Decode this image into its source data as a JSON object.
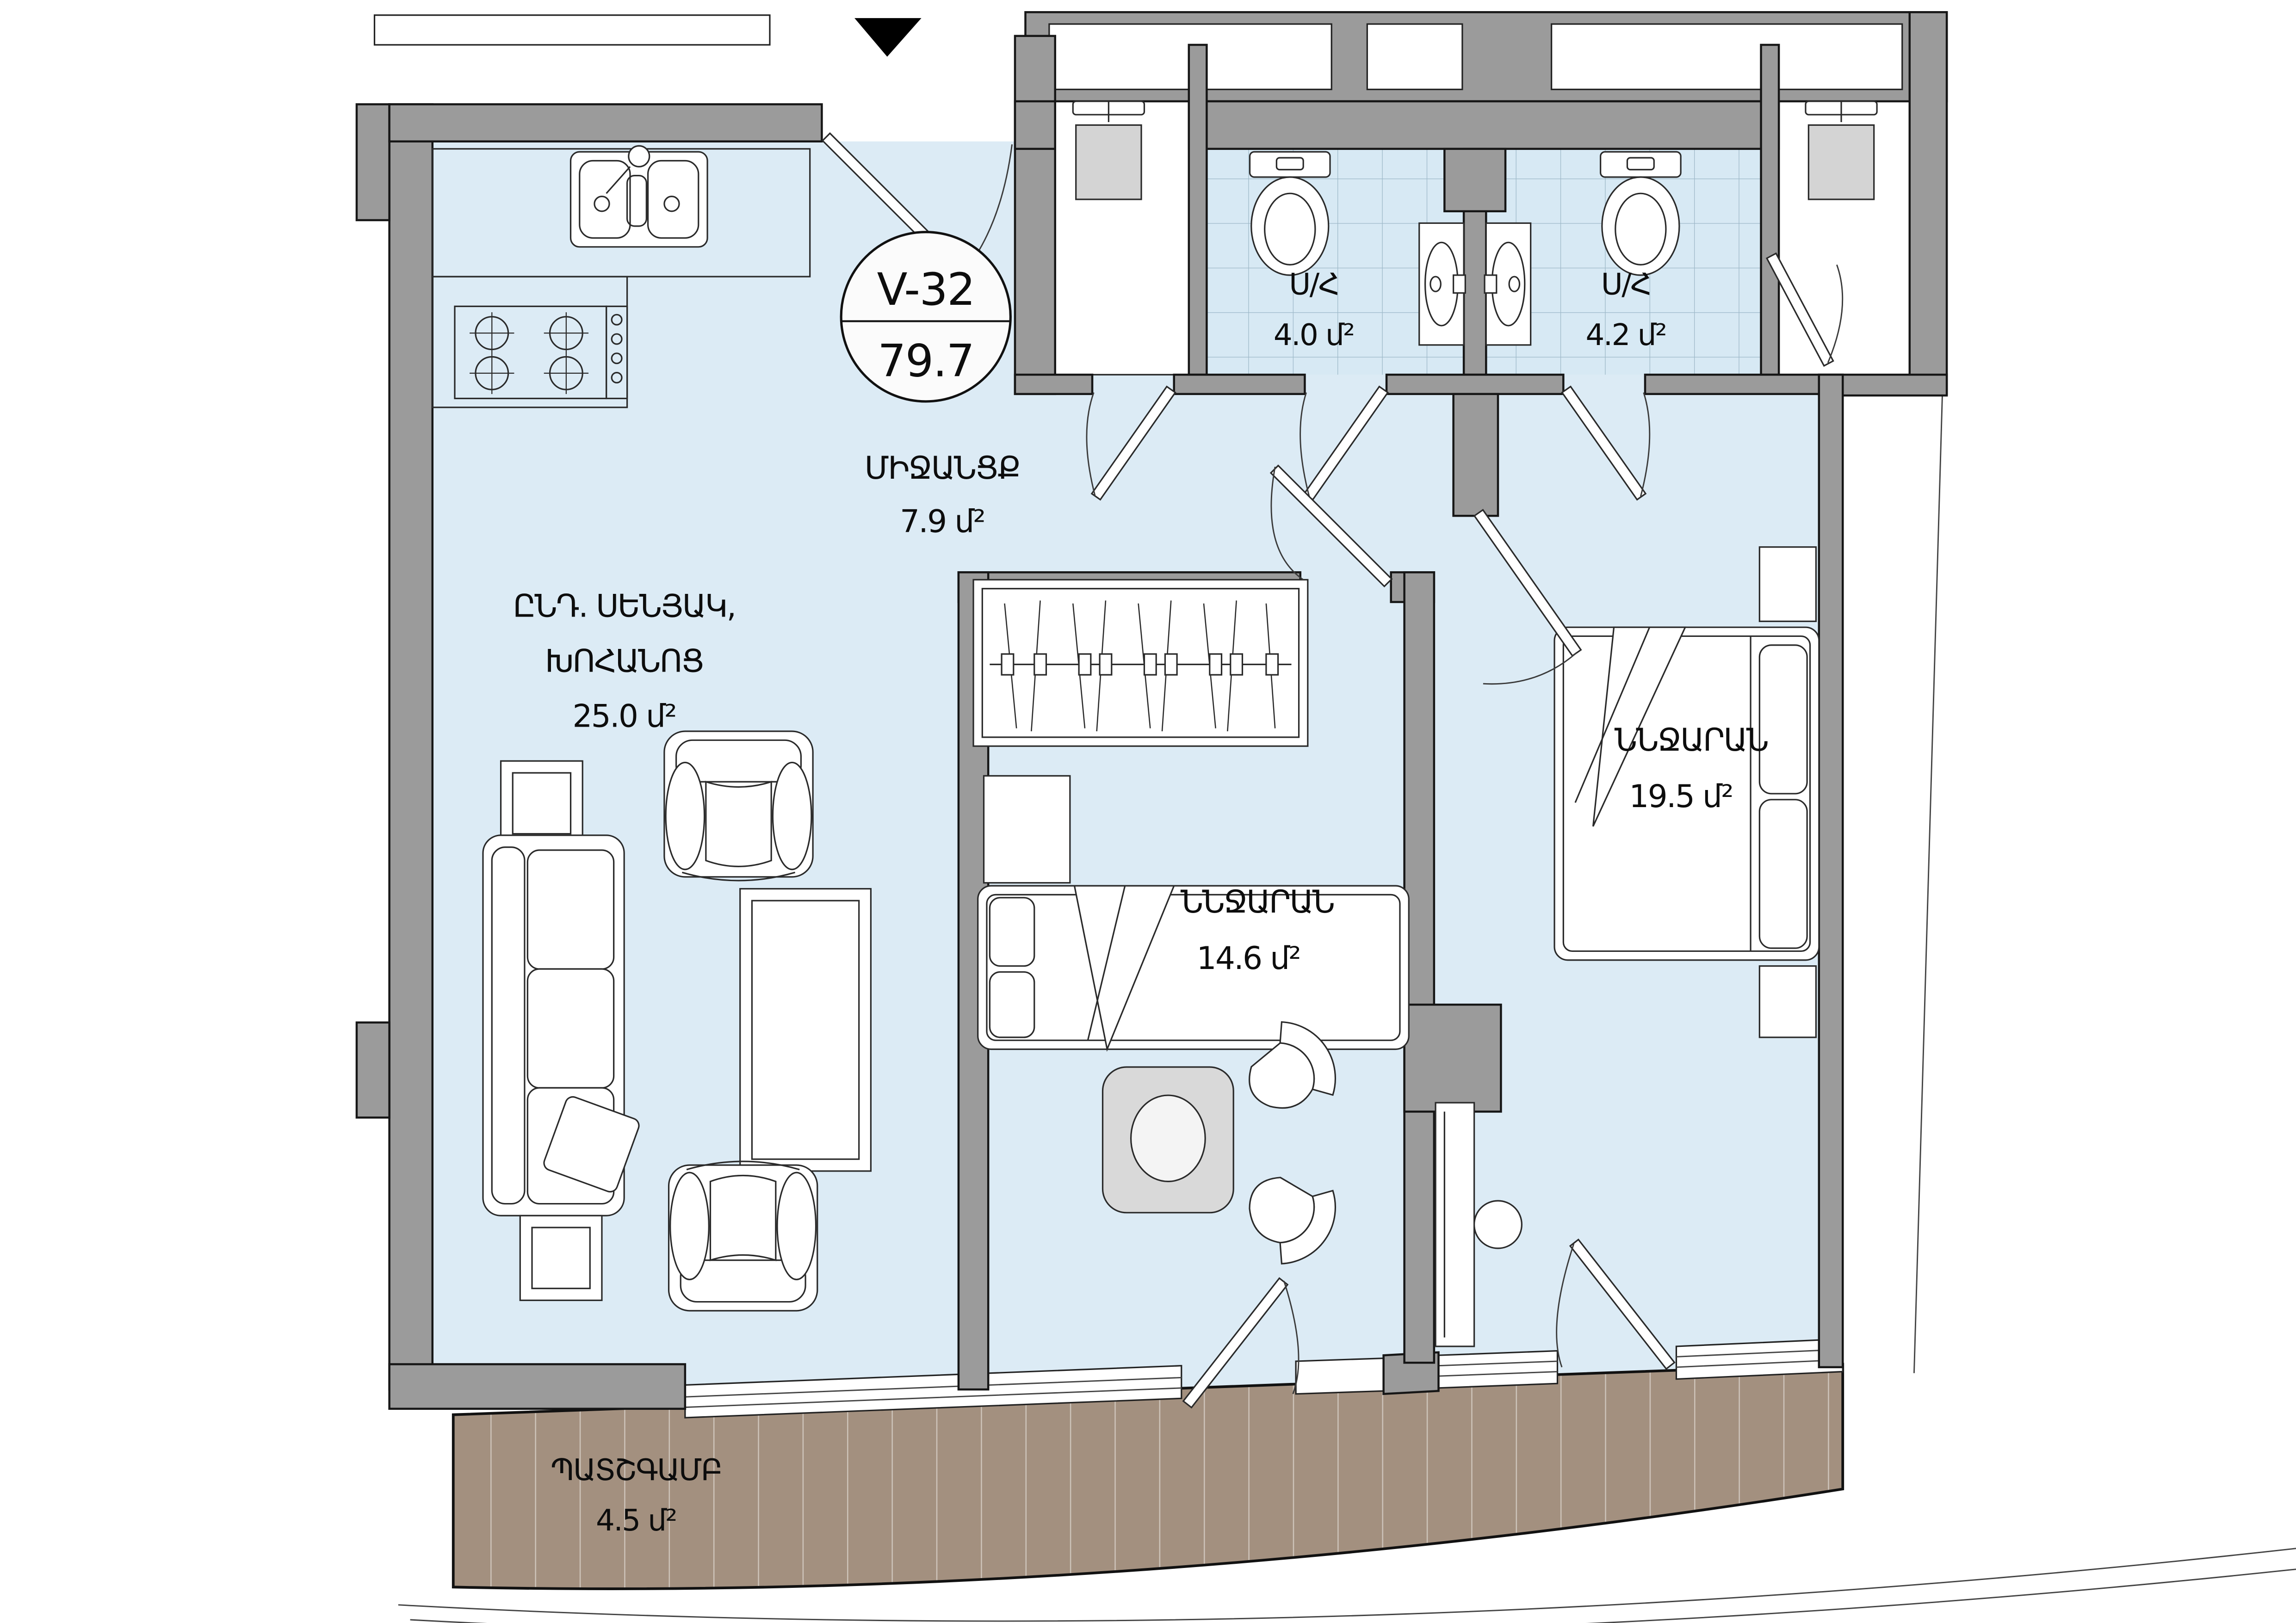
{
  "unit": {
    "id": "V-32",
    "total_area": "79.7"
  },
  "rooms": {
    "hallway": {
      "name": "ՄԻՋԱՆՑՔ",
      "area": "7.9 մ²"
    },
    "living_kitchen": {
      "name_line1": "ԸՆԴ. ՍԵՆՅԱԿ,",
      "name_line2": "ԽՈՀԱՆՈՑ",
      "area": "25.0 մ²"
    },
    "bathroom_1": {
      "name": "Ս/Հ",
      "area": "4.0 մ²"
    },
    "bathroom_2": {
      "name": "Ս/Հ",
      "area": "4.2 մ²"
    },
    "bedroom_1": {
      "name": "ՆՆՋԱՐԱՆ",
      "area": "14.6 մ²"
    },
    "bedroom_2": {
      "name": "ՆՆՋԱՐԱՆ",
      "area": "19.5 մ²"
    },
    "balcony": {
      "name": "ՊԱՏՇԳԱՄԲ",
      "area": "4.5 մ²"
    }
  },
  "colors": {
    "floor": "#dcebf5",
    "wall": "#9b9b9b",
    "balcony_wood": "#a3907f",
    "tile_line": "#9db8c8",
    "table_gray": "#d9d9d9"
  }
}
